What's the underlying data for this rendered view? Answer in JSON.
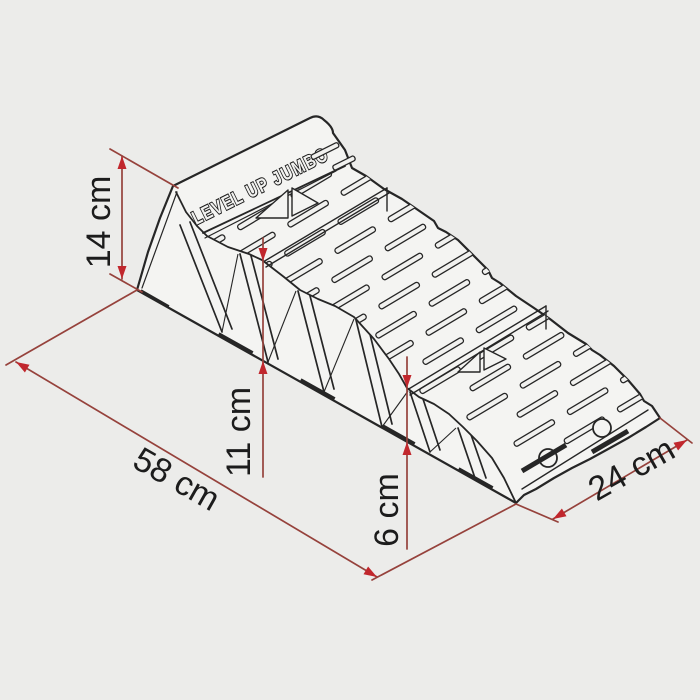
{
  "diagram_type": "product-dimension-drawing",
  "product_text": "LEVEL UP JUMBO",
  "dimensions": [
    {
      "id": "total-height",
      "label": "14 cm"
    },
    {
      "id": "length",
      "label": "58 cm"
    },
    {
      "id": "middle-step-height",
      "label": "11 cm"
    },
    {
      "id": "low-step-height",
      "label": "6 cm"
    },
    {
      "id": "width",
      "label": "24 cm"
    }
  ],
  "colors": {
    "background": "#ececea",
    "line_art": "#262626",
    "dimension_line": "#96423c",
    "arrowhead": "#c1272d",
    "label_text": "#1c1c1c"
  }
}
